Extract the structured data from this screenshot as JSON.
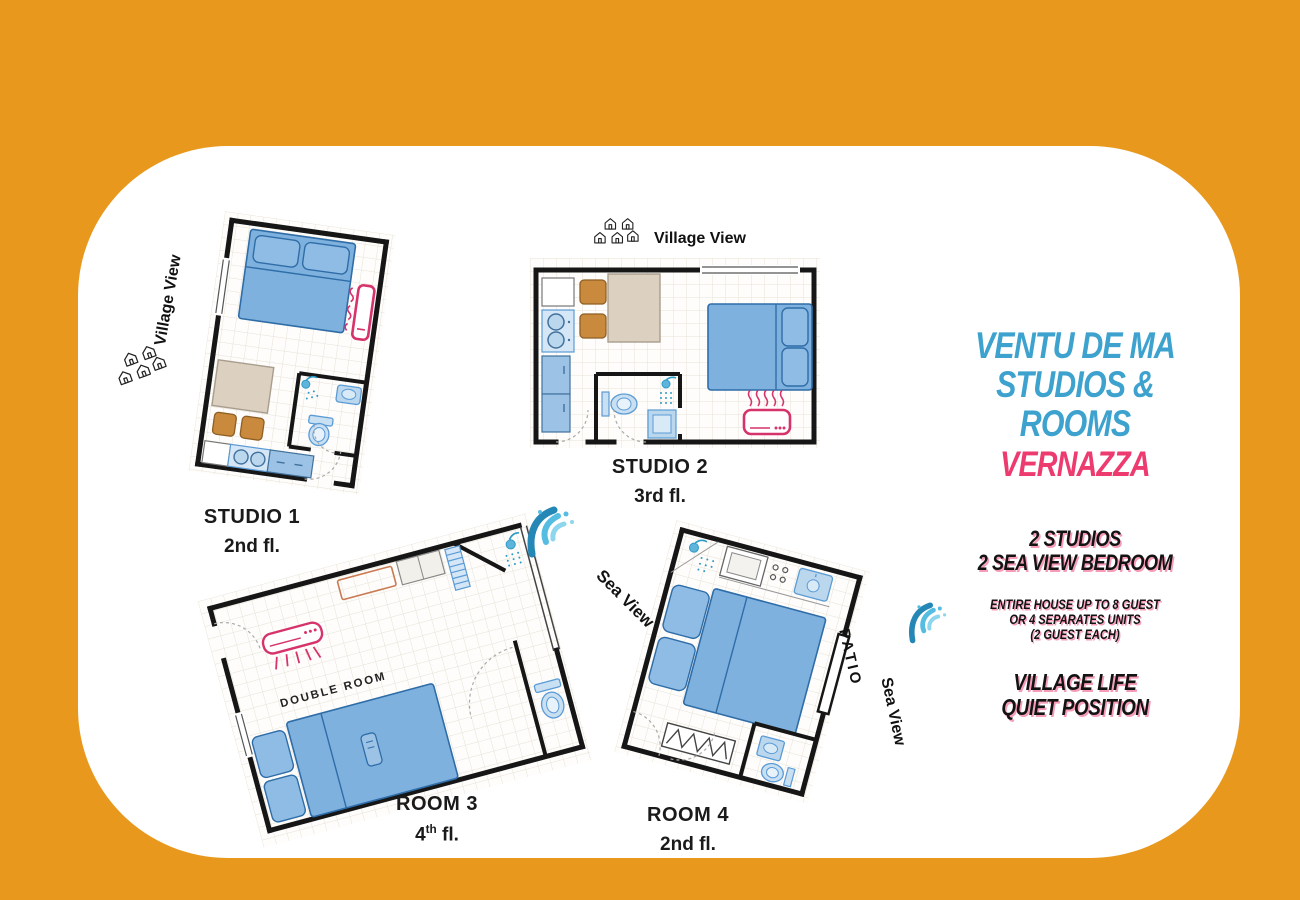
{
  "colors": {
    "background_orange": "#E8991D",
    "panel_white": "#FFFFFF",
    "brand_blue": "#3EA2CE",
    "brand_pink": "#ED3A6F",
    "plan_furniture_blue": "#7EB1DE",
    "plan_accent_pink": "#D6336C",
    "wood_brown": "#C98A3D",
    "table_beige": "#DCD0C0"
  },
  "info_panel": {
    "title_line1": "VENTU DE MA",
    "title_line2": "STUDIOS & ROOMS",
    "title_line3": "VERNAZZA",
    "capacity_line1": "2 STUDIOS",
    "capacity_line2": "2 SEA VIEW BEDROOM",
    "details_line1": "ENTIRE HOUSE UP TO 8 GUEST",
    "details_line2": "OR 4 SEPARATES UNITS",
    "details_line3": "(2 GUEST EACH)",
    "highlight_line1": "VILLAGE LIFE",
    "highlight_line2": "QUIET POSITION"
  },
  "plans": {
    "studio1": {
      "name": "STUDIO 1",
      "floor": "2nd fl.",
      "view_label": "Village View",
      "view_icon": "village-houses-icon"
    },
    "studio2": {
      "name": "STUDIO 2",
      "floor": "3rd fl.",
      "view_label": "Village View",
      "view_icon": "village-houses-icon"
    },
    "room3": {
      "name": "ROOM 3",
      "floor_number": "4",
      "floor_ordinal": "th",
      "floor_rest": " fl.",
      "view_label": "Sea View",
      "view_icon": "sea-wave-icon",
      "interior_label": "DOUBLE ROOM"
    },
    "room4": {
      "name": "ROOM 4",
      "floor": "2nd fl.",
      "view_label": "Sea View",
      "view_icon": "sea-wave-icon",
      "patio_label": "PATIO"
    }
  }
}
